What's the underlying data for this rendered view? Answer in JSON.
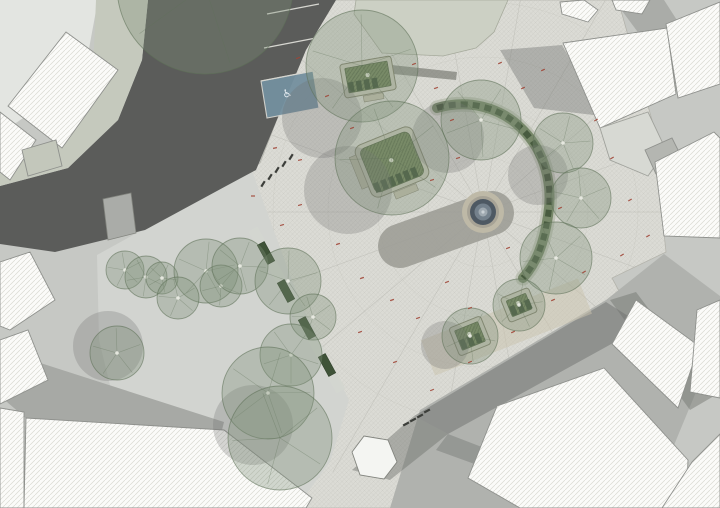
{
  "canvas": {
    "w": 720,
    "h": 508,
    "base": "#c6c8c4"
  },
  "patterns": {
    "pav_bg": "#dbdbd5",
    "pav_line": "#cbcbc4",
    "bld_bg": "#fbfbf9",
    "bld_line": "#d9d9d3",
    "grn_bg": "#75875f",
    "grn_line": "#5a6c48"
  },
  "ground": [
    {
      "n": "block-top-left",
      "pts": "0,0 98,0 88,54 52,98 0,134",
      "f": "#e3e5e1"
    },
    {
      "n": "plaza-paving",
      "pts": "300,0 618,0 652,120 666,252 612,278 640,330 562,432 468,480 392,508 294,508 256,296 226,182 260,163 306,44",
      "h": "pav",
      "s": "#b4b4ac",
      "sw": 0.8
    }
  ],
  "radial": {
    "cx": 483,
    "cy": 212,
    "count": 18,
    "len": 300,
    "color": "#b7b7b0",
    "rings": [
      55,
      105,
      155,
      210
    ]
  },
  "areas": [
    {
      "n": "lawn",
      "pts": "356,0 508,0 494,32 476,48 443,56 382,53 354,14",
      "f": "#ccd0c4",
      "s": "#a6aa9c",
      "sw": 0.8
    },
    {
      "n": "park-ground",
      "pts": "97,255 229,182 252,171 300,302 349,400 330,462 296,508 188,508 148,468 118,418 99,340",
      "f": "#d2d4d0"
    },
    {
      "n": "asphalt-road",
      "pts": "148,0 336,0 306,50 256,170 228,185 145,230 55,252 0,244 0,186 68,168 118,120 142,60",
      "f": "#5b5c5a"
    },
    {
      "n": "sidewalk",
      "pts": "96,0 148,0 142,60 118,120 68,168 0,186 0,152 52,142 86,102 94,48",
      "f": "#c5c9bd"
    },
    {
      "n": "bus-platform",
      "pts": "103,199 131,193 136,233 108,240",
      "f": "#aaaca8",
      "s": "#83857f",
      "sw": 0.8
    },
    {
      "n": "road-bottom-left",
      "pts": "0,350 224,422 220,438 28,420 0,396",
      "f": "#a7a9a5"
    },
    {
      "n": "road-bottom-right",
      "pts": "390,508 420,410 606,300 664,254 720,296 720,334 648,508",
      "f": "#b0b2ae"
    },
    {
      "n": "shadow",
      "pts": "414,416 606,302 644,326 448,434",
      "f": "#6e706d",
      "o": 0.5
    },
    {
      "n": "shadow",
      "pts": "352,470 414,416 448,434 390,480",
      "f": "#6e706d",
      "o": 0.45
    },
    {
      "n": "shadow",
      "pts": "448,434 640,508 596,508 436,450",
      "f": "#6e706d",
      "o": 0.4
    },
    {
      "n": "shadow",
      "pts": "610,300 636,292 714,396 690,410",
      "f": "#6e706d",
      "o": 0.45
    },
    {
      "n": "shadow",
      "pts": "500,50 562,45 602,116 534,108",
      "f": "#6e706d",
      "o": 0.4
    },
    {
      "n": "shadow",
      "pts": "614,0 664,0 700,56 672,78",
      "f": "#8e908c",
      "o": 0.5
    },
    {
      "n": "shadow",
      "pts": "363,62 457,72 456,80 362,71",
      "f": "#55574f",
      "o": 0.5
    }
  ],
  "parking": {
    "lines": [
      [
        267,
        14,
        319,
        4
      ],
      [
        264,
        48,
        316,
        38
      ],
      [
        261,
        81,
        313,
        71
      ]
    ],
    "line_color": "#d6d6d0",
    "stall": {
      "pts": "261,81 313,71 319,108 267,118",
      "f": "#74909f",
      "s": "#d6d6d0"
    },
    "icon": "♿",
    "icon_x": 288,
    "icon_y": 97,
    "icon_rot": -11,
    "icon_fill": "#e4ebf0"
  },
  "overlays": [
    {
      "n": "gravel-path",
      "x1": 428,
      "y1": 358,
      "x2": 585,
      "y2": 296,
      "stroke": "#cbc4ae",
      "w": 38,
      "o": 0.5,
      "cap": "butt"
    },
    {
      "n": "shadow-band",
      "x1": 400,
      "y1": 246,
      "x2": 492,
      "y2": 213,
      "stroke": "#9b9b94",
      "w": 44,
      "o": 0.85,
      "cap": "round"
    }
  ],
  "fountain": {
    "cx": 483,
    "cy": 212,
    "rings": [
      {
        "r": 21,
        "f": "#beb9a7"
      },
      {
        "r": 16,
        "f": "#a7a396"
      },
      {
        "r": 13,
        "f": "#4e5963"
      },
      {
        "r": 8.5,
        "f": "#74818c"
      },
      {
        "r": 4.5,
        "f": "#9fa9b0"
      },
      {
        "r": 1.6,
        "f": "#c9d0d4"
      }
    ]
  },
  "buildings": [
    {
      "n": "building",
      "pts": "66,32 118,70 62,148 8,106"
    },
    {
      "n": "building",
      "pts": "0,112 36,140 10,180 0,172"
    },
    {
      "n": "building-annex",
      "pts": "22,150 56,140 62,166 28,176",
      "f": "#c3c7bb"
    },
    {
      "n": "building",
      "pts": "0,262 30,252 55,300 10,330 0,326"
    },
    {
      "n": "building",
      "pts": "0,340 28,330 48,380 0,404"
    },
    {
      "n": "building",
      "pts": "0,408 24,412 24,508 0,508"
    },
    {
      "n": "building",
      "pts": "26,418 224,430 312,498 306,508 24,508"
    },
    {
      "n": "building",
      "pts": "560,2 584,0 598,10 588,22 562,14"
    },
    {
      "n": "building",
      "pts": "612,0 650,0 642,14 616,10"
    },
    {
      "n": "building",
      "pts": "563,43 667,28 676,94 600,128"
    },
    {
      "n": "building",
      "pts": "666,24 720,2 720,84 678,98"
    },
    {
      "n": "forecourt",
      "pts": "600,128 648,112 666,150 648,176 610,160",
      "f": "#d7d9d3",
      "s": "#a0a29c"
    },
    {
      "n": "building-annex",
      "pts": "645,150 672,138 684,162 656,174",
      "f": "#b4b6b1"
    },
    {
      "n": "building",
      "pts": "655,162 714,132 720,138 720,238 664,236"
    },
    {
      "n": "building",
      "pts": "636,300 699,346 678,408 612,344"
    },
    {
      "n": "building",
      "pts": "697,310 720,300 720,398 690,392"
    },
    {
      "n": "building",
      "pts": "497,406 604,368 688,460 686,508 520,508 468,478"
    },
    {
      "n": "building",
      "pts": "692,462 720,434 720,508 662,508"
    },
    {
      "n": "kiosk",
      "pts": "352,452 364,436 388,440 397,462 384,479 360,475",
      "f": "#f4f5f2",
      "s": "#82847e"
    }
  ],
  "building_style": {
    "s": "#8f918d",
    "sw": 0.9
  },
  "sbench": {
    "d": "M 437,108 C 468,99 500,107 521,128 C 546,152 553,186 548,216 C 544,243 537,262 523,278",
    "outer": "#b9bdaf",
    "ow": 15,
    "inner": "#6f8260",
    "iw": 10,
    "slat": "#3f5338",
    "slw": 6,
    "dash": "7 5"
  },
  "planters": {
    "outer_fill": "#c7c7b8",
    "outer_stroke": "#84846f",
    "inner_stroke": "#4e5f40",
    "slat_fill": "#3d5136",
    "seat_fill": "#c2bfae",
    "seat_stroke": "#8e8b7a",
    "dot": "#dfe3d2",
    "items": [
      {
        "x": 368,
        "y": 77,
        "rot": -10,
        "w": 52,
        "h": 34,
        "rx": 3,
        "seats": [
          [
            -8,
            18,
            20,
            6
          ]
        ]
      },
      {
        "x": 392,
        "y": 162,
        "rot": -22,
        "w": 62,
        "h": 56,
        "rx": 8,
        "seats": [
          [
            -38,
            -20,
            7,
            34
          ],
          [
            -10,
            29,
            24,
            7
          ]
        ]
      },
      {
        "x": 470,
        "y": 336,
        "rot": -22,
        "w": 34,
        "h": 30,
        "rx": 3,
        "seats": []
      },
      {
        "x": 519,
        "y": 305,
        "rot": -22,
        "w": 30,
        "h": 26,
        "rx": 3,
        "seats": []
      }
    ]
  },
  "bench_row": {
    "x1": 253,
    "y1": 229,
    "x2": 341,
    "y2": 391,
    "band": "#d4d7d0",
    "bw": 10,
    "angle": 61.5,
    "bl": 22,
    "bwd": 8,
    "fill": "#3f5338",
    "stroke": "#2c3a26",
    "benches": [
      [
        266,
        253
      ],
      [
        286,
        291
      ],
      [
        307,
        328
      ],
      [
        327,
        365
      ]
    ]
  },
  "bollards": {
    "fill": "#3c3e3a",
    "a": {
      "rot": -58,
      "pts": [
        [
          263,
          184
        ],
        [
          270,
          177
        ],
        [
          277,
          170
        ],
        [
          284,
          164
        ],
        [
          291,
          157
        ]
      ]
    },
    "b": {
      "rot": -28,
      "pts": [
        [
          406,
          424
        ],
        [
          413,
          420
        ],
        [
          420,
          416
        ],
        [
          427,
          411
        ]
      ]
    }
  },
  "tree_shadows": {
    "fill": "#6f716e",
    "o": 0.28,
    "items": [
      [
        322,
        118,
        40
      ],
      [
        348,
        190,
        44
      ],
      [
        448,
        137,
        36
      ],
      [
        538,
        175,
        30
      ],
      [
        108,
        346,
        35
      ],
      [
        445,
        345,
        24
      ],
      [
        253,
        425,
        40
      ]
    ]
  },
  "trees": {
    "fill": "#7e9077",
    "fo": 0.34,
    "stroke": "#5f7158",
    "so": 0.6,
    "dot": "#eef0e8",
    "items": [
      [
        205,
        -14,
        88
      ],
      [
        362,
        66,
        56
      ],
      [
        392,
        158,
        57
      ],
      [
        481,
        120,
        40
      ],
      [
        563,
        143,
        30
      ],
      [
        581,
        198,
        30
      ],
      [
        556,
        258,
        36
      ],
      [
        470,
        336,
        28
      ],
      [
        519,
        305,
        26
      ],
      [
        125,
        270,
        19
      ],
      [
        146,
        277,
        21
      ],
      [
        162,
        278,
        16
      ],
      [
        206,
        271,
        32
      ],
      [
        178,
        298,
        21
      ],
      [
        221,
        286,
        21
      ],
      [
        240,
        266,
        28
      ],
      [
        288,
        281,
        33
      ],
      [
        313,
        317,
        23
      ],
      [
        291,
        355,
        31
      ],
      [
        268,
        393,
        46
      ],
      [
        117,
        353,
        27
      ],
      [
        280,
        438,
        52
      ]
    ]
  },
  "red_marks": {
    "color": "#a04536",
    "items": [
      [
        298,
        58,
        -20
      ],
      [
        327,
        96,
        -20
      ],
      [
        352,
        128,
        -20
      ],
      [
        300,
        205,
        -15
      ],
      [
        282,
        225,
        -15
      ],
      [
        253,
        196,
        0
      ],
      [
        414,
        64,
        -20
      ],
      [
        436,
        88,
        -20
      ],
      [
        452,
        120,
        -20
      ],
      [
        500,
        63,
        -25
      ],
      [
        523,
        88,
        -25
      ],
      [
        543,
        70,
        -25
      ],
      [
        596,
        120,
        -30
      ],
      [
        612,
        158,
        -30
      ],
      [
        630,
        200,
        -30
      ],
      [
        648,
        236,
        -30
      ],
      [
        622,
        255,
        -30
      ],
      [
        584,
        272,
        -30
      ],
      [
        553,
        300,
        -25
      ],
      [
        513,
        332,
        -25
      ],
      [
        470,
        308,
        -20
      ],
      [
        447,
        282,
        -20
      ],
      [
        432,
        180,
        -15
      ],
      [
        458,
        158,
        -15
      ],
      [
        508,
        248,
        -20
      ],
      [
        560,
        208,
        -25
      ],
      [
        418,
        318,
        -20
      ],
      [
        392,
        300,
        -18
      ],
      [
        362,
        278,
        -18
      ],
      [
        338,
        244,
        -18
      ],
      [
        360,
        332,
        -20
      ],
      [
        395,
        362,
        -20
      ],
      [
        432,
        390,
        -22
      ],
      [
        470,
        362,
        -22
      ],
      [
        300,
        160,
        -12
      ],
      [
        275,
        148,
        -10
      ]
    ]
  }
}
